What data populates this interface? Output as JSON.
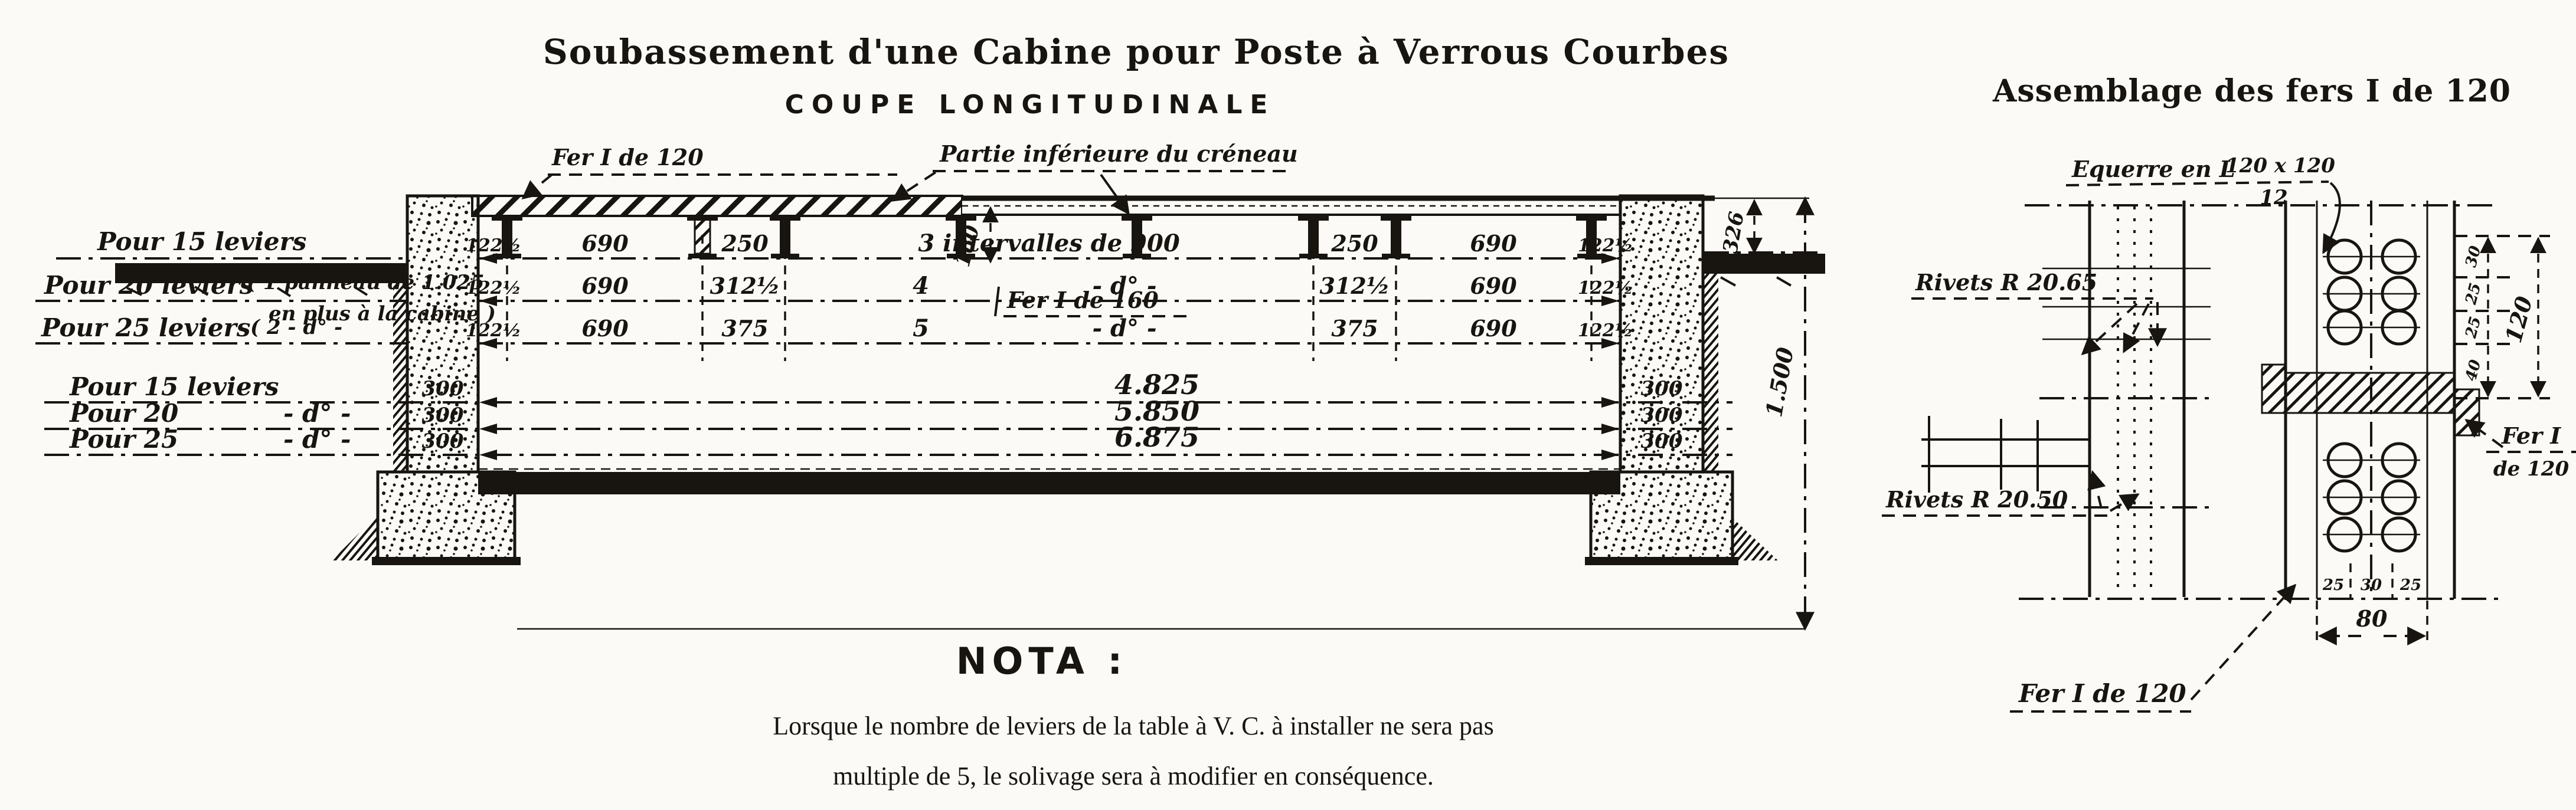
{
  "titles": {
    "main": "Soubassement d'une Cabine pour Poste à Verrous Courbes",
    "subtitle": "COUPE LONGITUDINALE",
    "assembly": "Assemblage des fers I de 120"
  },
  "annotations": {
    "fer120_top": "Fer I de 120",
    "partie_inferieure": "Partie inférieure du créneau",
    "fer160": "Fer I de 160",
    "dim_160": "160",
    "dim_326": "326",
    "dim_1500": "1.500"
  },
  "upper_rows": {
    "r1": {
      "label": "Pour 15 leviers",
      "cells": [
        "122½",
        "690",
        "250",
        "3 intervalles de 900",
        "250",
        "690",
        "122½"
      ]
    },
    "r2": {
      "label": "Pour 20 leviers",
      "note1": "( 1 panneau de 1.025",
      "note2": "en plus à la cabine )",
      "cells": [
        "122½",
        "690",
        "312½",
        "4",
        "- d° -",
        "312½",
        "690",
        "122½"
      ]
    },
    "r3": {
      "label": "Pour 25 leviers",
      "note": "( 2     - d° -",
      "cells": [
        "122½",
        "690",
        "375",
        "5",
        "- d° -",
        "375",
        "690",
        "122½"
      ]
    }
  },
  "lower_rows": {
    "r1": {
      "label": "Pour 15 leviers",
      "left300": "300",
      "right300": "300",
      "total": "4.825"
    },
    "r2": {
      "label": "Pour 20",
      "ditto": "- d° -",
      "left300": "300",
      "right300": "300",
      "total": "5.850"
    },
    "r3": {
      "label": "Pour 25",
      "ditto": "- d° -",
      "left300": "300",
      "right300": "300",
      "total": "6.875"
    }
  },
  "nota": {
    "heading": "NOTA :",
    "line1": "Lorsque le nombre de leviers de la table à V. C. à installer ne sera pas",
    "line2": "multiple de 5, le solivage sera à modifier en conséquence."
  },
  "assembly": {
    "equerre": "Equerre en L",
    "equerre_dims": "120 x 120",
    "equerre_denom": "12",
    "rivets_top": "Rivets R 20.65",
    "rivets_bottom": "Rivets R 20.50",
    "fer_side1": "Fer I",
    "fer_side2": "de 120",
    "fer_bottom": "Fer I de 120",
    "chain": [
      "30",
      "25",
      "25",
      "40"
    ],
    "chain_total": "120",
    "width_cells": [
      "25",
      "30",
      "25"
    ],
    "width_total": "80"
  }
}
